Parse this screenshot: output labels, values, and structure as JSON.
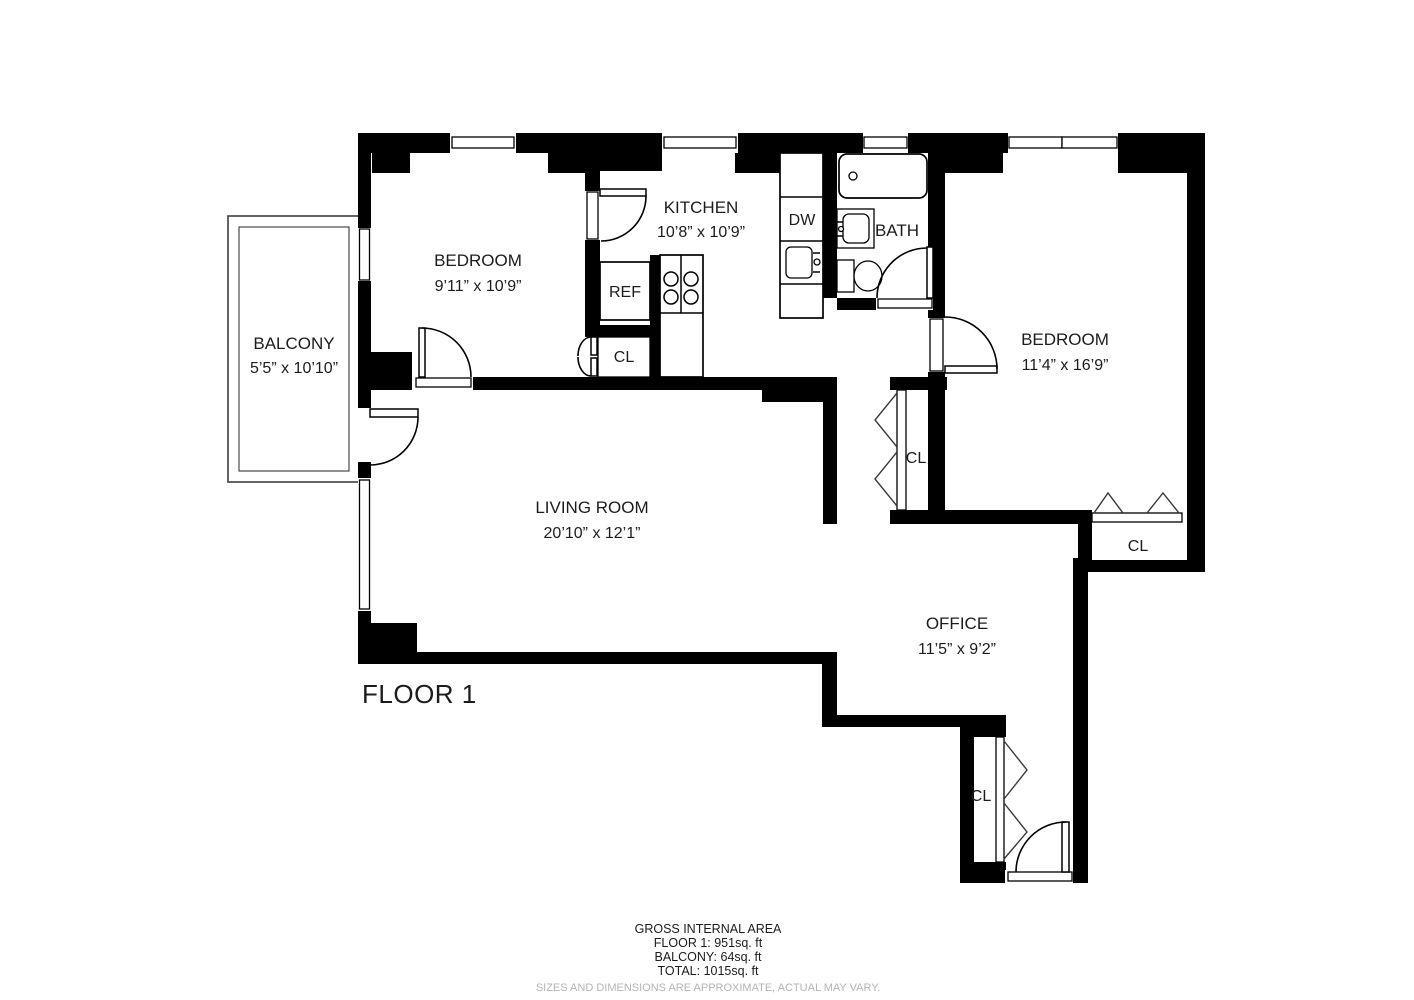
{
  "floor_label": "FLOOR 1",
  "rooms": {
    "balcony": {
      "name": "BALCONY",
      "dims": "5’5” x 10’10”"
    },
    "bedroom1": {
      "name": "BEDROOM",
      "dims": "9’11” x 10’9”"
    },
    "kitchen": {
      "name": "KITCHEN",
      "dims": "10’8” x 10’9”"
    },
    "bath": {
      "name": "BATH"
    },
    "bedroom2": {
      "name": "BEDROOM",
      "dims": "11’4” x 16’9”"
    },
    "living_room": {
      "name": "LIVING ROOM",
      "dims": "20’10” x 12’1”"
    },
    "office": {
      "name": "OFFICE",
      "dims": "11’5” x 9’2”"
    }
  },
  "labels": {
    "refrigerator": "REF",
    "dishwasher": "DW",
    "closet": "CL"
  },
  "summary": {
    "title": "GROSS INTERNAL AREA",
    "floor_area": "FLOOR 1: 951sq. ft",
    "balcony_area": "BALCONY: 64sq. ft",
    "total_area": "TOTAL: 1015sq. ft",
    "disclaimer": "SIZES AND DIMENSIONS ARE APPROXIMATE, ACTUAL MAY VARY."
  },
  "colors": {
    "wall": "#000000",
    "text": "#1c1c1c",
    "disclaimer_text": "#b4b4b4",
    "background": "#ffffff"
  }
}
